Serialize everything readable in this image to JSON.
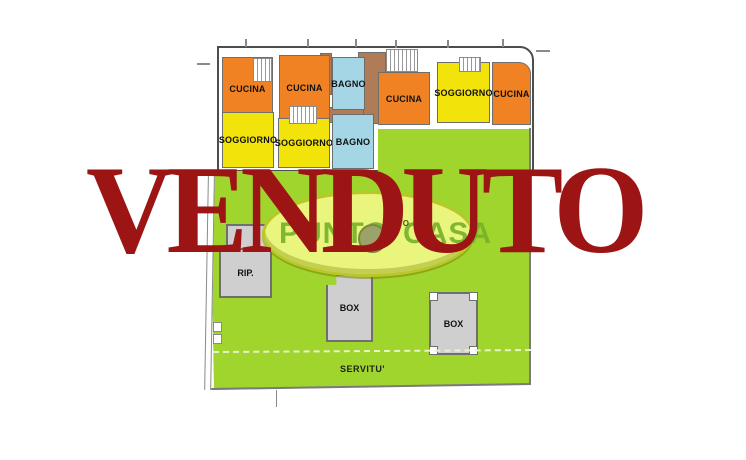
{
  "stamp": {
    "text": "VENDUTO",
    "color": "#9c1414"
  },
  "watermark": {
    "left_text": "PUNTO",
    "right_text": "CASA",
    "small_text_left": "DIN",
    "small_text_right": "ATO"
  },
  "plan": {
    "rooms": [
      {
        "id": "cucina-1",
        "label": "CUCINA"
      },
      {
        "id": "cucina-2",
        "label": "CUCINA"
      },
      {
        "id": "bagno-1",
        "label": "BAGNO"
      },
      {
        "id": "cucina-3",
        "label": "CUCINA"
      },
      {
        "id": "soggiorno-3",
        "label": "SOGGIORNO"
      },
      {
        "id": "cucina-4",
        "label": "CUCINA"
      },
      {
        "id": "soggiorno-1",
        "label": "SOGGIORNO"
      },
      {
        "id": "soggiorno-2",
        "label": "SOGGIORNO"
      },
      {
        "id": "bagno-2",
        "label": "BAGNO"
      },
      {
        "id": "rip",
        "label": "RIP."
      },
      {
        "id": "box-1",
        "label": "BOX"
      },
      {
        "id": "box-2",
        "label": "BOX"
      }
    ],
    "garden": {
      "servitu_label": "SERVITU'"
    },
    "colors": {
      "kitchen": "#f08223",
      "living": "#f2e30a",
      "bath": "#a5d6e6",
      "hall": "#b07c58",
      "garden": "#9fd52c",
      "structure": "#cfcfcf",
      "stamp_red": "#9c1414",
      "oval_fill": "#e9f57d"
    }
  }
}
